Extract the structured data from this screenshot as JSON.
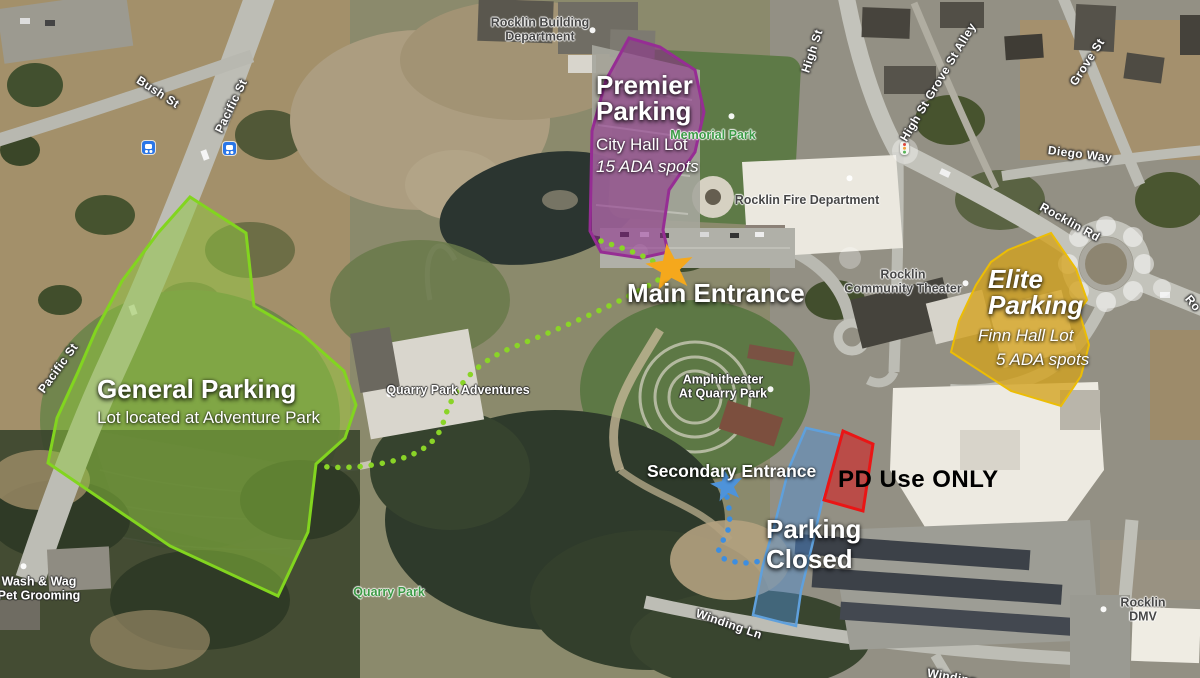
{
  "overlays": {
    "general": {
      "title": "General Parking",
      "subtitle": "Lot located at Adventure Park"
    },
    "premier": {
      "title": "Premier Parking",
      "subtitle": "City Hall Lot",
      "ada": "15 ADA spots"
    },
    "elite": {
      "title": "Elite Parking",
      "subtitle": "Finn Hall Lot",
      "ada": "5 ADA spots"
    },
    "pd": {
      "label": "PD Use ONLY"
    },
    "closed": {
      "label": "Parking Closed"
    },
    "entrances": {
      "main": "Main Entrance",
      "secondary": "Secondary Entrance"
    }
  },
  "pois": {
    "building_dept": "Rocklin Building\nDepartment",
    "memorial_park": "Memorial Park",
    "fire_dept": "Rocklin Fire Department",
    "community_theater": "Rocklin\nCommunity Theater",
    "amphitheater": "Amphitheater\nAt Quarry Park",
    "qpa": "Quarry Park Adventures",
    "wash_wag": "Wash & Wag\nPet Grooming",
    "quarry_park": "Quarry Park",
    "dmv": "Rocklin DMV"
  },
  "streets": {
    "bush": "Bush St",
    "pacific_a": "Pacific St",
    "pacific_b": "Pacific St",
    "high": "High St",
    "alley": "High St Grove St Alley",
    "grove": "Grove St",
    "diego": "Diego Way",
    "rocklin_rd": "Rocklin Rd",
    "winding": "Winding Ln",
    "rocklin_rd_partial": "Ro",
    "winding_partial": "Winding"
  },
  "colors": {
    "general_fill": "#90c83d",
    "general_stroke": "#82d51f",
    "premier_fill": "#8e2a8c",
    "premier_stroke": "#962d94",
    "elite_fill": "#d4a11c",
    "elite_stroke": "#ecbd05",
    "closed_fill": "#4e8fd6",
    "closed_stroke": "#5fa0dc",
    "pd_fill": "#d42020",
    "pd_stroke": "#ea1515",
    "main_star": "#f5a81c",
    "secondary_star": "#4e93da",
    "green_path": "#8ad427",
    "blue_path": "#3d8ee0"
  }
}
